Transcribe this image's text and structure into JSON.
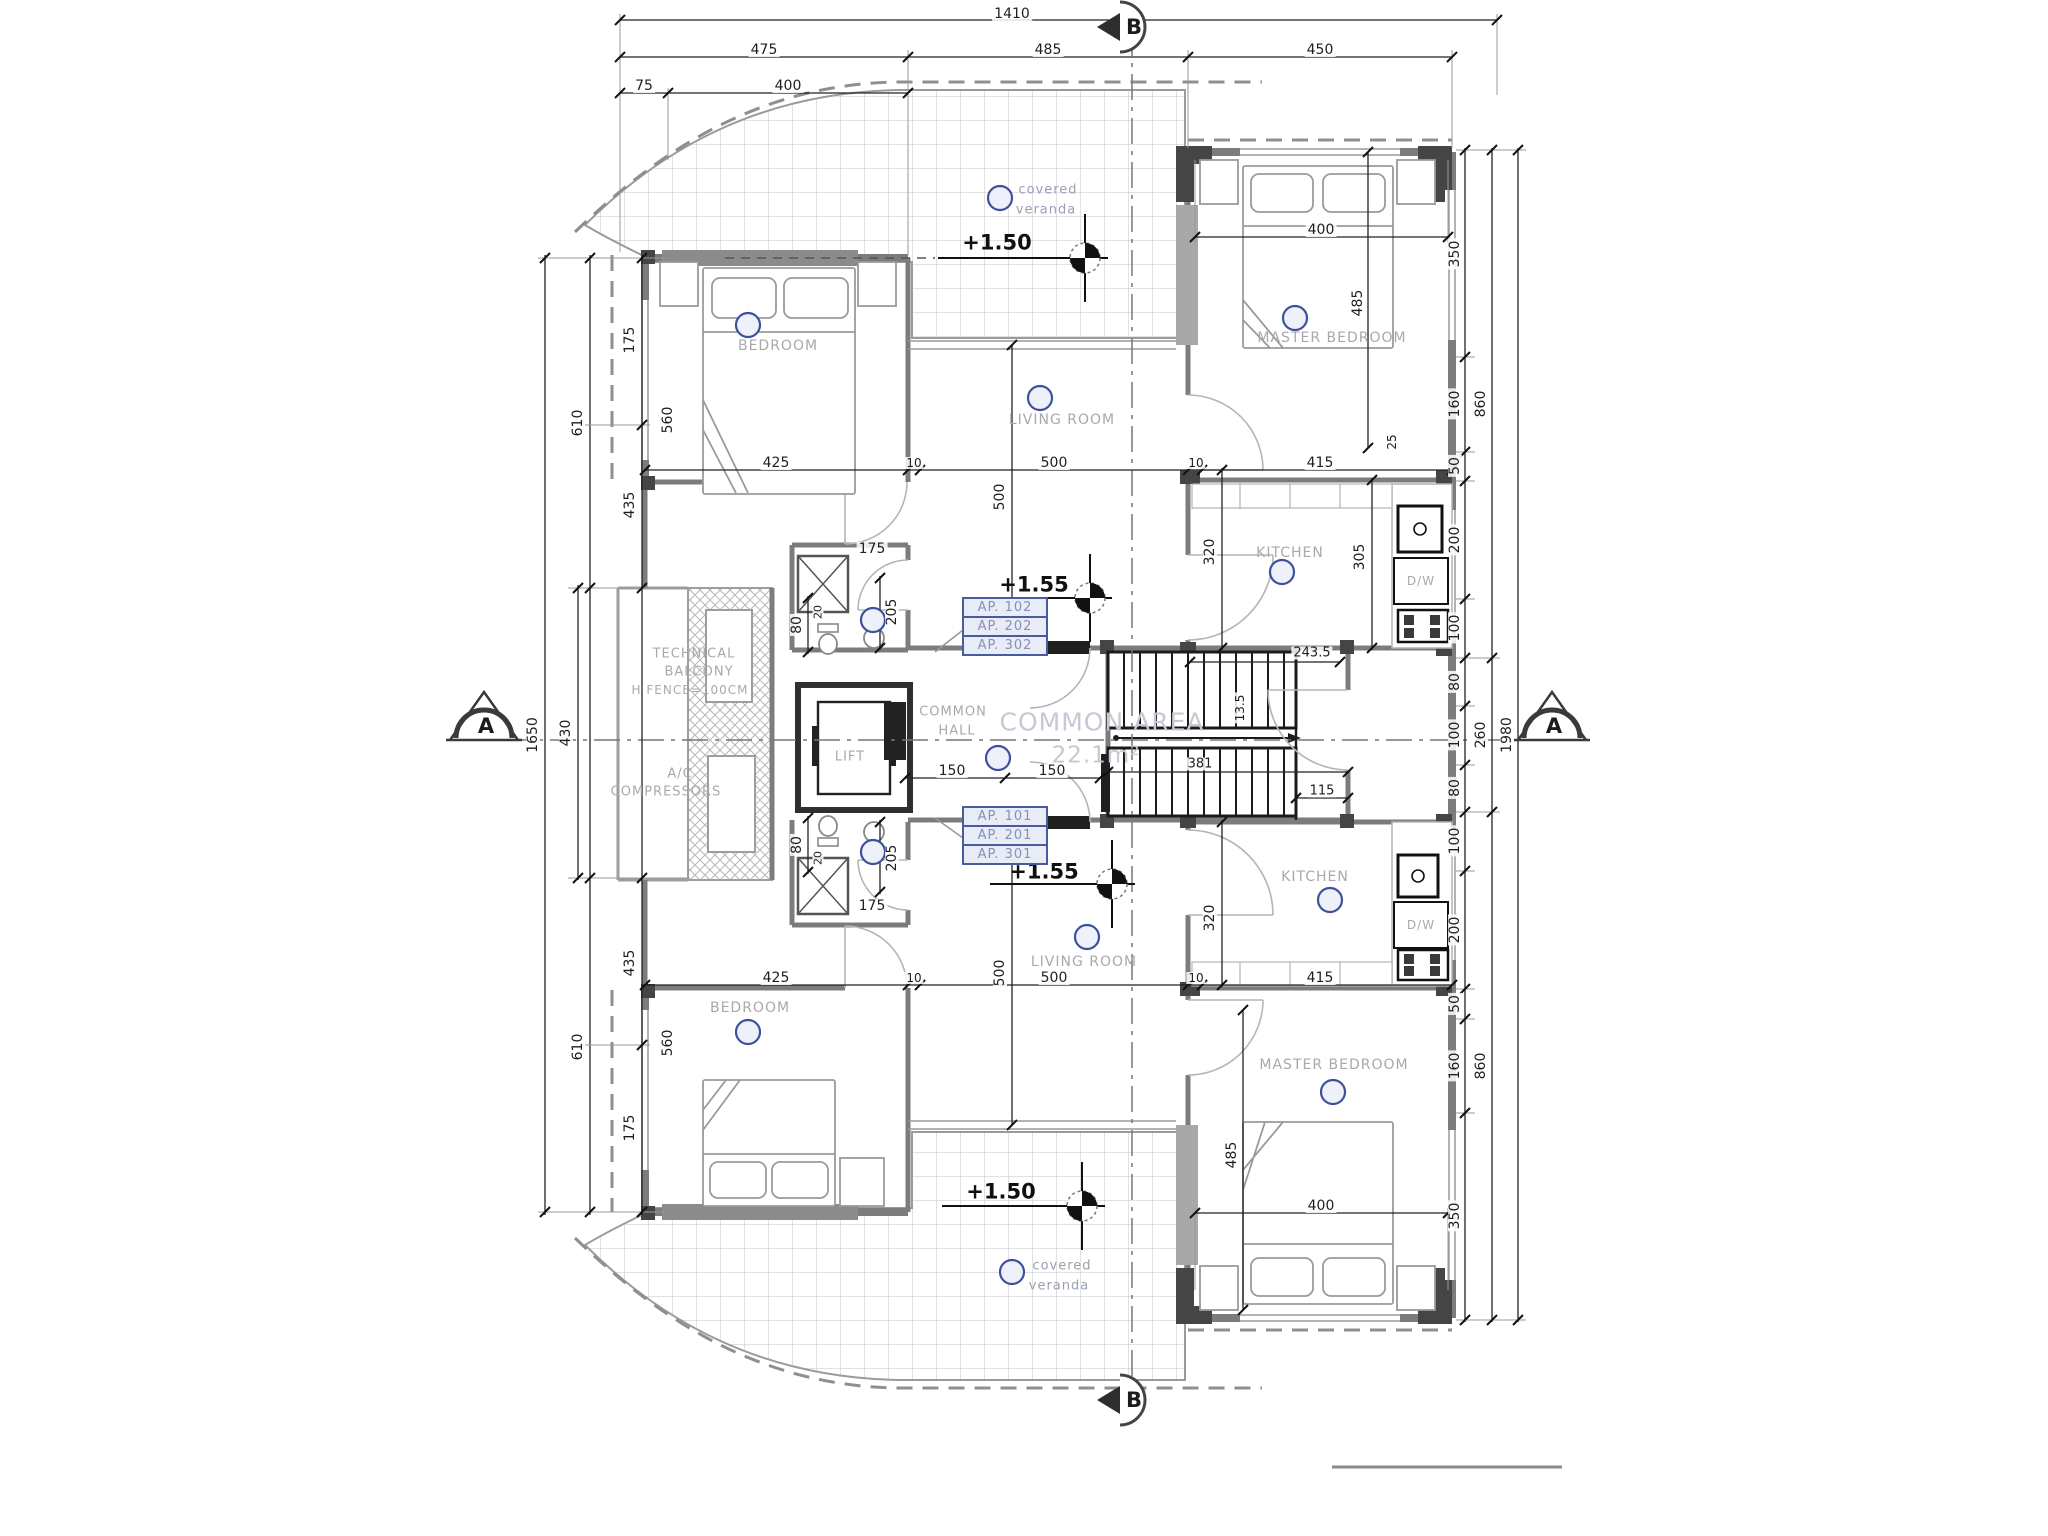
{
  "drawing": {
    "type": "architectural-floor-plan",
    "section_markers": {
      "top": "B",
      "bottom": "B",
      "left": "A",
      "right": "A"
    },
    "ap_boxes": {
      "top": [
        "AP. 102",
        "AP. 202",
        "AP. 302"
      ],
      "bottom": [
        "AP. 101",
        "AP. 201",
        "AP. 301"
      ]
    },
    "levels": {
      "veranda_top": "+1.50",
      "floor_top": "+1.55",
      "floor_bottom": "+1.55",
      "veranda_bottom": "+1.50"
    },
    "common_area": {
      "title": "COMMON AREA",
      "value": "22.1m²"
    }
  },
  "colors": {
    "dim": "#1e1e1e",
    "room": "#a9a9a9",
    "veranda_text": "#9aa0b2",
    "area_text": "#c5c9d4",
    "level": "#101010",
    "ap_border": "#4a5a9e",
    "ap_text": "#8690b8",
    "symbol": "#3d509c"
  },
  "labels": [
    {
      "t": "1410",
      "x": 1012,
      "y": 14,
      "n": "dim-total-width"
    },
    {
      "t": "475",
      "x": 764,
      "y": 50
    },
    {
      "t": "485",
      "x": 1048,
      "y": 50
    },
    {
      "t": "450",
      "x": 1320,
      "y": 50
    },
    {
      "t": "75",
      "x": 644,
      "y": 86
    },
    {
      "t": "400",
      "x": 788,
      "y": 86
    },
    {
      "t": "1650",
      "x": 533,
      "y": 735,
      "r": 1,
      "n": "dim-left-total"
    },
    {
      "t": "430",
      "x": 566,
      "y": 733,
      "r": 1
    },
    {
      "t": "610",
      "x": 578,
      "y": 423,
      "r": 1
    },
    {
      "t": "610",
      "x": 578,
      "y": 1047,
      "r": 1
    },
    {
      "t": "175",
      "x": 630,
      "y": 340,
      "r": 1
    },
    {
      "t": "435",
      "x": 630,
      "y": 505,
      "r": 1
    },
    {
      "t": "435",
      "x": 630,
      "y": 963,
      "r": 1
    },
    {
      "t": "175",
      "x": 630,
      "y": 1128,
      "r": 1
    },
    {
      "t": "350",
      "x": 1455,
      "y": 254,
      "r": 1
    },
    {
      "t": "160",
      "x": 1455,
      "y": 404,
      "r": 1
    },
    {
      "t": "50",
      "x": 1455,
      "y": 466,
      "r": 1
    },
    {
      "t": "200",
      "x": 1455,
      "y": 540,
      "r": 1
    },
    {
      "t": "100",
      "x": 1455,
      "y": 628,
      "r": 1
    },
    {
      "t": "80",
      "x": 1455,
      "y": 682,
      "r": 1
    },
    {
      "t": "100",
      "x": 1455,
      "y": 735,
      "r": 1
    },
    {
      "t": "80",
      "x": 1455,
      "y": 788,
      "r": 1
    },
    {
      "t": "100",
      "x": 1455,
      "y": 841,
      "r": 1
    },
    {
      "t": "200",
      "x": 1455,
      "y": 930,
      "r": 1
    },
    {
      "t": "50",
      "x": 1455,
      "y": 1004,
      "r": 1
    },
    {
      "t": "160",
      "x": 1455,
      "y": 1066,
      "r": 1
    },
    {
      "t": "350",
      "x": 1455,
      "y": 1216,
      "r": 1
    },
    {
      "t": "860",
      "x": 1481,
      "y": 404,
      "r": 1
    },
    {
      "t": "260",
      "x": 1481,
      "y": 735,
      "r": 1
    },
    {
      "t": "860",
      "x": 1481,
      "y": 1066,
      "r": 1
    },
    {
      "t": "1980",
      "x": 1507,
      "y": 735,
      "r": 1,
      "n": "dim-right-total"
    },
    {
      "t": "BEDROOM",
      "x": 778,
      "y": 346,
      "c": "r",
      "n": "room-label-bedroom-upper"
    },
    {
      "t": "560",
      "x": 668,
      "y": 420,
      "r": 1
    },
    {
      "t": "425",
      "x": 776,
      "y": 463
    },
    {
      "t": "10",
      "x": 914,
      "y": 463,
      "s": 12
    },
    {
      "t": "500",
      "x": 1054,
      "y": 463
    },
    {
      "t": "10",
      "x": 1196,
      "y": 463,
      "s": 12
    },
    {
      "t": "415",
      "x": 1320,
      "y": 463
    },
    {
      "t": "covered",
      "x": 1048,
      "y": 190,
      "c": "v",
      "s": 13,
      "n": "room-label-veranda-top"
    },
    {
      "t": "veranda",
      "x": 1046,
      "y": 210,
      "c": "v",
      "s": 13
    },
    {
      "t": "+1.50",
      "x": 997,
      "y": 243,
      "c": "l",
      "s": 21,
      "b": 1,
      "n": "level-marker-top-veranda"
    },
    {
      "t": "MASTER BEDROOM",
      "x": 1332,
      "y": 338,
      "c": "r",
      "n": "room-label-master-upper"
    },
    {
      "t": "400",
      "x": 1321,
      "y": 230
    },
    {
      "t": "485",
      "x": 1358,
      "y": 303,
      "r": 1
    },
    {
      "t": "LIVING ROOM",
      "x": 1062,
      "y": 420,
      "c": "r",
      "n": "room-label-living-upper"
    },
    {
      "t": "500",
      "x": 1000,
      "y": 497,
      "r": 1
    },
    {
      "t": "+1.55",
      "x": 1034,
      "y": 585,
      "c": "l",
      "s": 21,
      "b": 1,
      "n": "level-marker-upper-floor"
    },
    {
      "t": "KITCHEN",
      "x": 1290,
      "y": 553,
      "c": "r",
      "n": "room-label-kitchen-upper"
    },
    {
      "t": "320",
      "x": 1210,
      "y": 552,
      "r": 1
    },
    {
      "t": "305",
      "x": 1360,
      "y": 557,
      "r": 1
    },
    {
      "t": "25",
      "x": 1392,
      "y": 442,
      "r": 1,
      "s": 12
    },
    {
      "t": "D/W",
      "x": 1421,
      "y": 581,
      "c": "r",
      "s": 12,
      "n": "dishwasher-label-upper"
    },
    {
      "t": "175",
      "x": 872,
      "y": 549
    },
    {
      "t": "80",
      "x": 797,
      "y": 625,
      "r": 1
    },
    {
      "t": "20",
      "x": 818,
      "y": 612,
      "r": 1,
      "s": 11
    },
    {
      "t": "205",
      "x": 892,
      "y": 612,
      "r": 1
    },
    {
      "t": "COMMON",
      "x": 953,
      "y": 712,
      "c": "r",
      "s": 13,
      "n": "room-label-common-hall"
    },
    {
      "t": "HALL",
      "x": 957,
      "y": 731,
      "c": "r",
      "s": 13
    },
    {
      "t": "COMMON AREA",
      "x": 1102,
      "y": 722,
      "c": "a",
      "s": 25,
      "n": "common-area-title"
    },
    {
      "t": "22.1m²",
      "x": 1096,
      "y": 756,
      "c": "a",
      "s": 23,
      "n": "common-area-value"
    },
    {
      "t": "LIFT",
      "x": 850,
      "y": 757,
      "c": "r",
      "s": 13,
      "n": "room-label-lift"
    },
    {
      "t": "150",
      "x": 952,
      "y": 771
    },
    {
      "t": "150",
      "x": 1052,
      "y": 771
    },
    {
      "t": "243.5",
      "x": 1312,
      "y": 653,
      "s": 13
    },
    {
      "t": "13.5",
      "x": 1240,
      "y": 708,
      "r": 1,
      "s": 12
    },
    {
      "t": "381",
      "x": 1200,
      "y": 764,
      "s": 13
    },
    {
      "t": "115",
      "x": 1322,
      "y": 791,
      "s": 13
    },
    {
      "t": "TECHNICAL",
      "x": 694,
      "y": 654,
      "c": "r",
      "s": 13,
      "n": "label-technical-balcony"
    },
    {
      "t": "BALCONY",
      "x": 699,
      "y": 672,
      "c": "r",
      "s": 13
    },
    {
      "t": "H FENCE=100CM",
      "x": 690,
      "y": 690,
      "c": "r",
      "s": 12
    },
    {
      "t": "A/C",
      "x": 680,
      "y": 774,
      "c": "r",
      "s": 13,
      "n": "label-ac-compressors"
    },
    {
      "t": "COMPRESSORS",
      "x": 666,
      "y": 792,
      "c": "r",
      "s": 13
    },
    {
      "t": "80",
      "x": 797,
      "y": 845,
      "r": 1
    },
    {
      "t": "20",
      "x": 818,
      "y": 858,
      "r": 1,
      "s": 11
    },
    {
      "t": "205",
      "x": 892,
      "y": 858,
      "r": 1
    },
    {
      "t": "175",
      "x": 872,
      "y": 906
    },
    {
      "t": "+1.55",
      "x": 1044,
      "y": 872,
      "c": "l",
      "s": 21,
      "b": 1,
      "n": "level-marker-lower-floor"
    },
    {
      "t": "LIVING ROOM",
      "x": 1084,
      "y": 962,
      "c": "r",
      "n": "room-label-living-lower"
    },
    {
      "t": "500",
      "x": 1000,
      "y": 973,
      "r": 1
    },
    {
      "t": "425",
      "x": 776,
      "y": 978
    },
    {
      "t": "10",
      "x": 914,
      "y": 978,
      "s": 12
    },
    {
      "t": "500",
      "x": 1054,
      "y": 978
    },
    {
      "t": "10",
      "x": 1196,
      "y": 978,
      "s": 12
    },
    {
      "t": "415",
      "x": 1320,
      "y": 978
    },
    {
      "t": "320",
      "x": 1210,
      "y": 918,
      "r": 1
    },
    {
      "t": "KITCHEN",
      "x": 1315,
      "y": 877,
      "c": "r",
      "n": "room-label-kitchen-lower"
    },
    {
      "t": "D/W",
      "x": 1421,
      "y": 925,
      "c": "r",
      "s": 12,
      "n": "dishwasher-label-lower"
    },
    {
      "t": "MASTER BEDROOM",
      "x": 1334,
      "y": 1065,
      "c": "r",
      "n": "room-label-master-lower"
    },
    {
      "t": "400",
      "x": 1321,
      "y": 1206
    },
    {
      "t": "485",
      "x": 1232,
      "y": 1155,
      "r": 1
    },
    {
      "t": "BEDROOM",
      "x": 750,
      "y": 1008,
      "c": "r",
      "n": "room-label-bedroom-lower"
    },
    {
      "t": "560",
      "x": 668,
      "y": 1043,
      "r": 1
    },
    {
      "t": "covered",
      "x": 1062,
      "y": 1266,
      "c": "v",
      "s": 13,
      "n": "room-label-veranda-bottom"
    },
    {
      "t": "veranda",
      "x": 1059,
      "y": 1286,
      "c": "v",
      "s": 13
    },
    {
      "t": "+1.50",
      "x": 1001,
      "y": 1192,
      "c": "l",
      "s": 21,
      "b": 1,
      "n": "level-marker-bottom-veranda"
    }
  ]
}
